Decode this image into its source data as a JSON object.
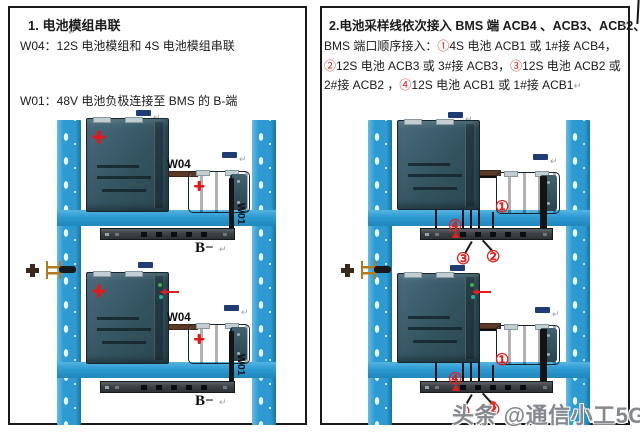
{
  "symbols": {
    "plus": "+",
    "pilcrow": "↵"
  },
  "left_panel": {
    "title": "1. 电池模组串联",
    "line_w04": "W04：12S 电池模组和 4S 电池模组串联",
    "line_w01": "W01：48V 电池负极连接至 BMS 的 B-端",
    "w04_label": "W04",
    "w01_label": "W01",
    "bms_label": "B−"
  },
  "right_panel": {
    "title": "2.电池采样线依次接入 BMS 端 ACB4 、ACB3、ACB2、ACB1",
    "instruction_segments": [
      {
        "text": "BMS 端口顺序接入：",
        "red": false
      },
      {
        "text": "①",
        "red": true
      },
      {
        "text": "4S 电池 ACB1 或 1#接 ACB4，",
        "red": false
      },
      {
        "text": "②",
        "red": true
      },
      {
        "text": "12S 电池 ACB3 或 3#接 ACB3，",
        "red": false
      },
      {
        "text": "③",
        "red": true
      },
      {
        "text": "12S 电池 ACB2 或 2#接 ACB2 ，",
        "red": false
      },
      {
        "text": "④",
        "red": true
      },
      {
        "text": "12S 电池 ACB1 或 1#接 ACB1",
        "red": false
      },
      {
        "text": "↵",
        "red": false,
        "mark": true
      }
    ],
    "callout_1": "①",
    "callout_2": "②",
    "callout_3": "③",
    "callout_4": "④"
  },
  "watermark": "头条 @通信小工5G",
  "colors": {
    "rack_blue": "#2d9ad2",
    "module_dark": "#33535f",
    "cable_brown": "#5e3a26",
    "cable_black": "#141414",
    "accent_red": "#e02020",
    "connector_navy": "#203c74",
    "terminal_orange": "#b5791f",
    "watermark_gray": "#85898e"
  }
}
